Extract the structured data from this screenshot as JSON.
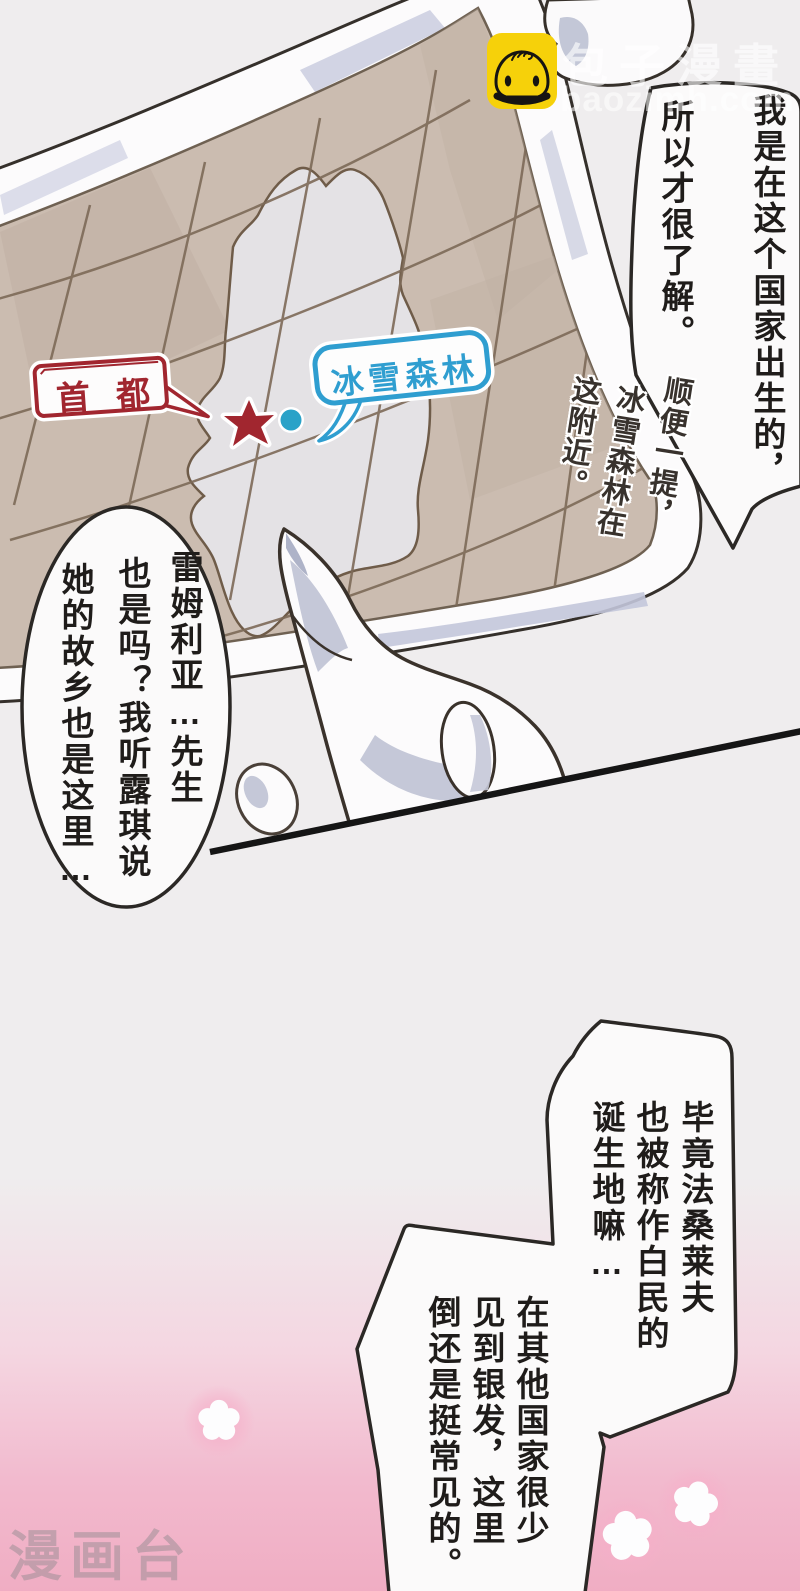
{
  "watermark": {
    "brand": "包子漫畫",
    "site": "baozimh.com",
    "icon": "baozi-bun-icon"
  },
  "corner_watermark": {
    "label": "漫画台"
  },
  "map": {
    "labels": {
      "capital": "首都",
      "forest": "冰雪森林"
    },
    "markers": {
      "capital_marker": "red-star",
      "forest_marker": "blue-dot"
    },
    "note_columns": [
      "顺便一提，",
      "冰雪森林在",
      "这附近。"
    ],
    "colors": {
      "capital_red": "#a1262f",
      "forest_blue": "#2f9ed0",
      "dot_teal": "#2aa2c8",
      "paper_tan": "#cbbcb0",
      "grid_brown": "#7d6a58",
      "land_gray": "#e4e2e5"
    }
  },
  "bubbles": {
    "top_right": {
      "columns": [
        "我是在这个国家出生的，",
        "所以才很了解。"
      ]
    },
    "left": {
      "columns": [
        "雷姆利亚…先生",
        "也是吗？我听露琪说",
        "她的故乡也是这里…"
      ]
    },
    "bottom_first": {
      "columns": [
        "毕竟法桑莱夫",
        "也被称作白民的",
        "诞生地嘛…"
      ]
    },
    "bottom_second": {
      "columns": [
        "在其他国家很少",
        "见到银发，这里",
        "倒还是挺常见的。"
      ]
    }
  },
  "scene_colors": {
    "background_gray": "#efedee",
    "background_pink": "#f0adc3",
    "panel_line_black": "#151515",
    "bubble_outline": "#2b2825"
  }
}
